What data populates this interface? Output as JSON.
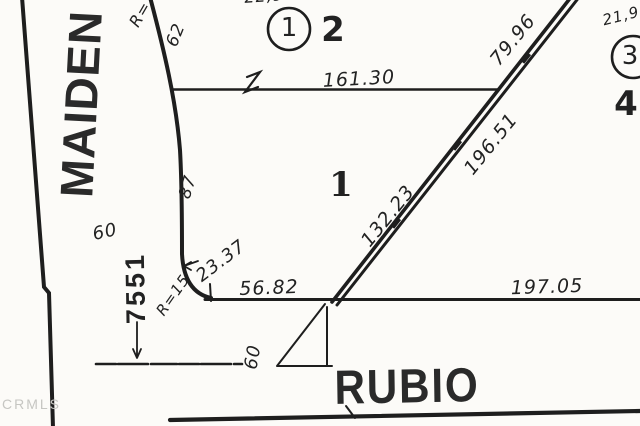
{
  "colors": {
    "ink": "#1e1e1e",
    "paper": "#fcfbf8",
    "watermark_gray": "#c6c6c2"
  },
  "streets": {
    "maiden": "MAIDEN",
    "rubio": "RUBIO"
  },
  "lots": {
    "circled_lot_1": "1",
    "lot_2": "2",
    "circled_lot_3": "3",
    "lot_4": "4",
    "parcel_1": "1"
  },
  "address": {
    "house_number": "7551"
  },
  "dimensions": {
    "north_line": "161.30",
    "diagonal_upper": "79.96",
    "diagonal_middle": "196.51",
    "diagonal_lower": "132.23",
    "south_line_east": "197.05",
    "south_line_west": "56.82",
    "corner_dim": "23.37",
    "corner_radius": "R=15",
    "radius_label": "R=",
    "curve_62": "62",
    "curve_87": "87",
    "maiden_width": "60",
    "rubio_width": "60",
    "area_top_partial": "22,9",
    "area_right_partial": "21,9"
  },
  "watermark": "CRMLS"
}
